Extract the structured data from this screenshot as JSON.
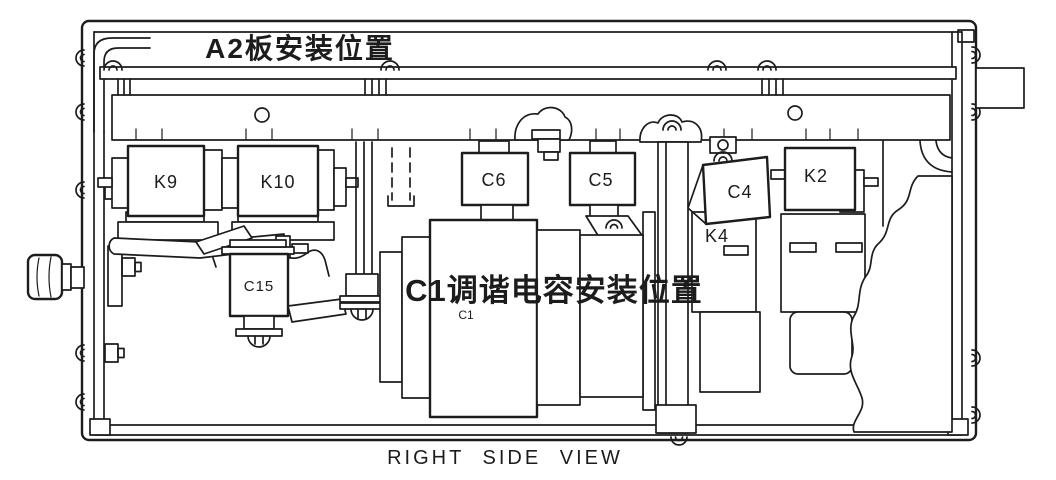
{
  "drawing": {
    "colors": {
      "ink": "#1c1c1c",
      "paper": "#ffffff"
    },
    "notes": {
      "a2_position": "A2板安装位置",
      "c1_position": "C1调谐电容安装位置"
    },
    "components": {
      "k9": "K9",
      "k10": "K10",
      "c6": "C6",
      "c5": "C5",
      "c4": "C4",
      "k2": "K2",
      "k4": "K4",
      "c15": "C15",
      "c1": "C1"
    },
    "caption": "RIGHT SIDE VIEW"
  }
}
